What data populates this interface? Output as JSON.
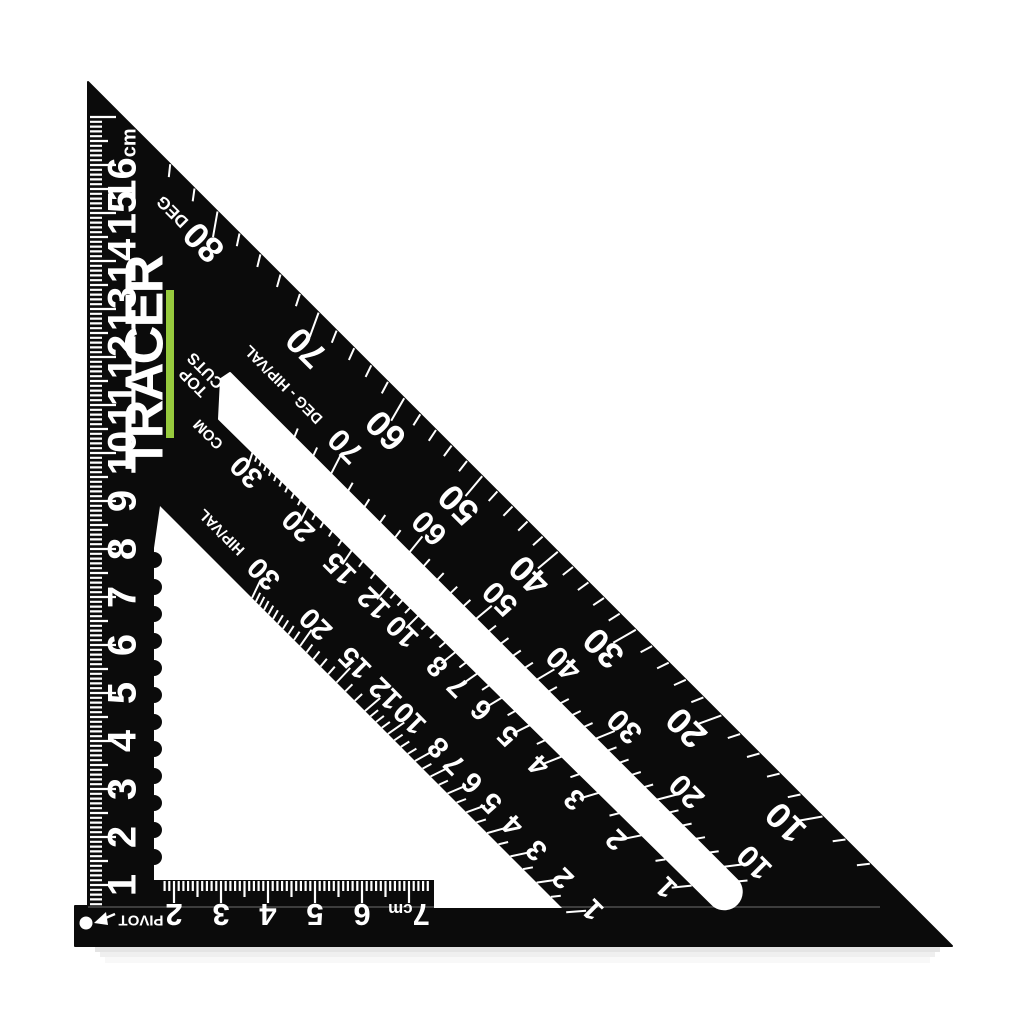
{
  "scene": {
    "description": "Black metric rafter speed square on white background",
    "background_color": "#ffffff",
    "body_color": "#0b0b0b",
    "marking_color": "#ffffff"
  },
  "brand": {
    "name": "TRACER",
    "accent_color": "#97ca3d"
  },
  "labels": {
    "top_cuts_line1": "TOP",
    "top_cuts_line2": "CUTS",
    "pivot": "PIVOT"
  },
  "left_ruler": {
    "unit": "cm",
    "numbers": [
      "1",
      "2",
      "3",
      "4",
      "5",
      "6",
      "7",
      "8",
      "9",
      "10",
      "11",
      "12",
      "13",
      "14",
      "15",
      "16"
    ],
    "unit_shown_on": "16"
  },
  "bottom_ruler": {
    "unit": "cm",
    "numbers": [
      "2",
      "3",
      "4",
      "5",
      "6",
      "7"
    ],
    "unit_shown_on": "7"
  },
  "degree_scale": {
    "first_number": "80",
    "unit_label": "DEG",
    "numbers": [
      "70",
      "60",
      "50",
      "40",
      "30",
      "20",
      "10"
    ]
  },
  "hip_val_degree_scale": {
    "first_number": "70",
    "unit_label": "DEG - HIP/VAL",
    "numbers": [
      "60",
      "50",
      "40",
      "30",
      "20",
      "10"
    ]
  },
  "common_scale": {
    "first_number": "30",
    "unit_label": "COM",
    "numbers": [
      "20",
      "15",
      "12",
      "10",
      "8",
      "7",
      "6",
      "5",
      "4",
      "3",
      "2",
      "1"
    ]
  },
  "hip_val_scale": {
    "first_number": "30",
    "unit_label": "HIP/VAL",
    "numbers": [
      "20",
      "15",
      "12",
      "10",
      "8",
      "7",
      "6",
      "5",
      "4",
      "3",
      "2",
      "1"
    ]
  }
}
